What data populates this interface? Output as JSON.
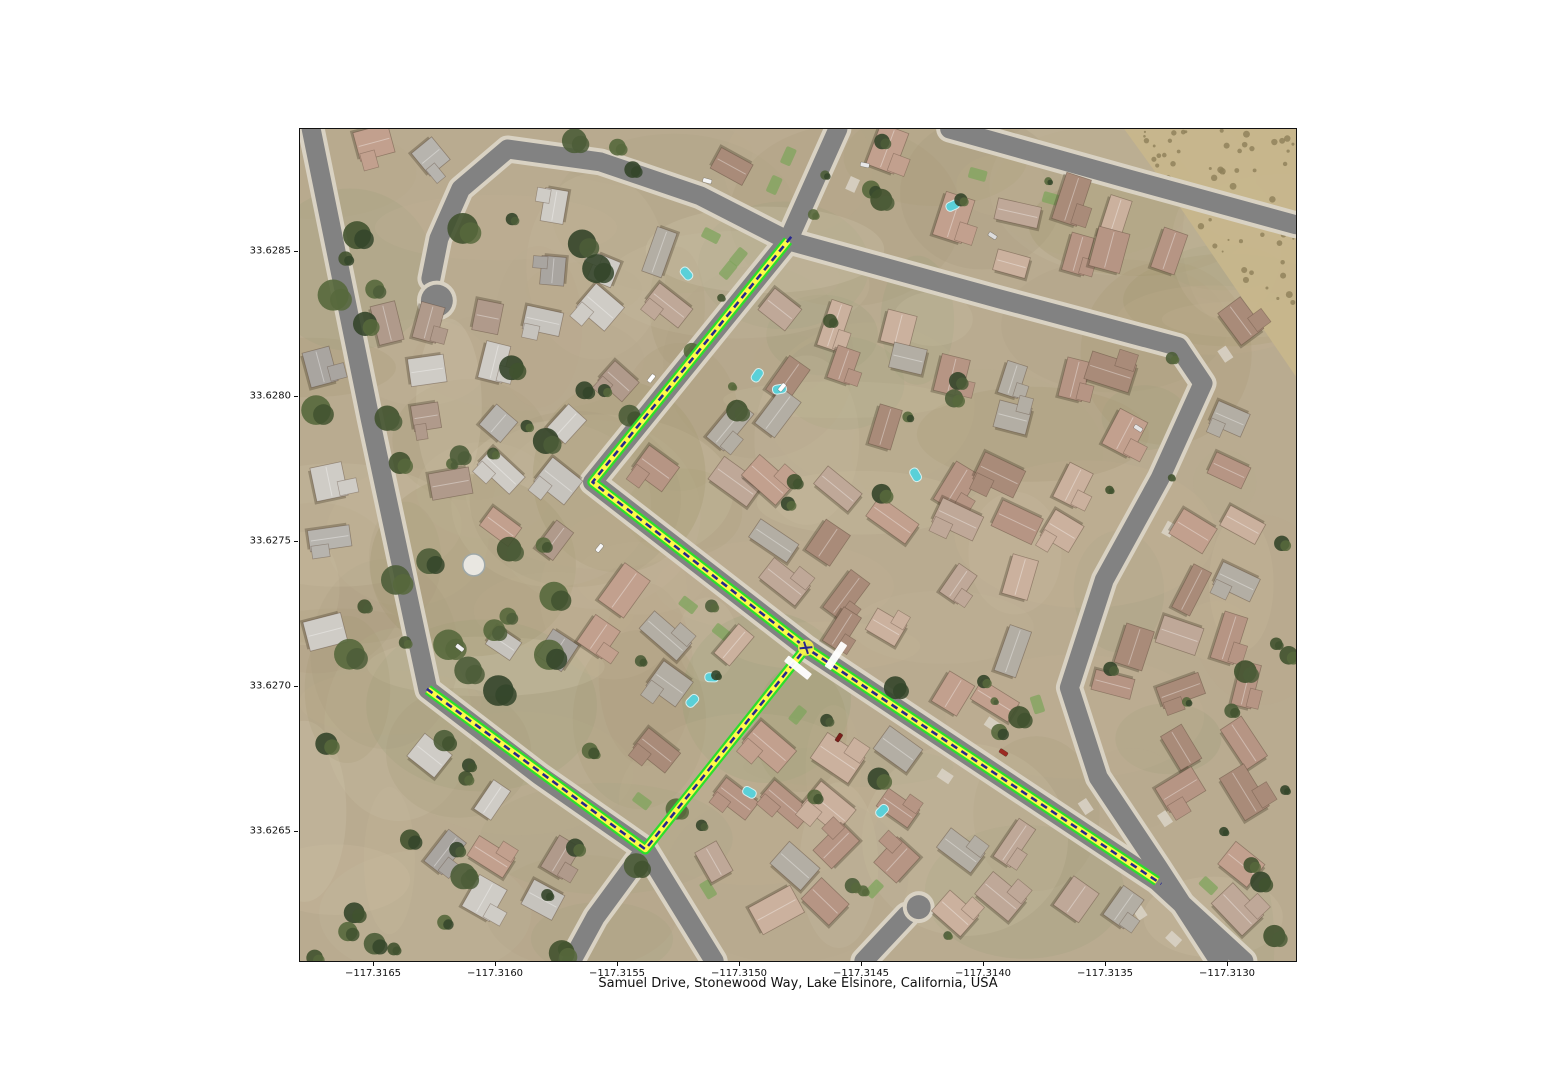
{
  "figure": {
    "title": "Samuel Drive, Stonewood Way, Lake Elsinore, California, USA",
    "background": "#ffffff"
  },
  "axes": {
    "x_ticks": [
      {
        "label": "−117.3165",
        "px": 74
      },
      {
        "label": "−117.3160",
        "px": 196
      },
      {
        "label": "−117.3155",
        "px": 318
      },
      {
        "label": "−117.3150",
        "px": 440
      },
      {
        "label": "−117.3145",
        "px": 562
      },
      {
        "label": "−117.3140",
        "px": 684
      },
      {
        "label": "−117.3135",
        "px": 806
      },
      {
        "label": "−117.3130",
        "px": 928
      }
    ],
    "y_ticks": [
      {
        "label": "33.6285",
        "px": 123
      },
      {
        "label": "33.6280",
        "px": 268
      },
      {
        "label": "33.6275",
        "px": 413
      },
      {
        "label": "33.6270",
        "px": 558
      },
      {
        "label": "33.6265",
        "px": 703
      }
    ]
  },
  "map": {
    "colors": {
      "ground": "#b9ab90",
      "scrub": "#c7b68c",
      "asphalt": "#828282",
      "sidewalk": "#d9d2c3",
      "route_casing": "#2cdf2c",
      "route_fill": "#fdf948",
      "route_center": "#26268f",
      "pool": "#5ad0d8",
      "lawn": "#7fa45c"
    },
    "route": {
      "name": "highlighted-route",
      "legs": [
        {
          "name": "north-leg",
          "points": [
            [
              489,
              112
            ],
            [
              293,
              354
            ],
            [
              507,
              520
            ]
          ]
        },
        {
          "name": "southeast-leg",
          "points": [
            [
              507,
              520
            ],
            [
              859,
              754
            ]
          ]
        },
        {
          "name": "west-leg",
          "points": [
            [
              507,
              520
            ],
            [
              346,
              722
            ],
            [
              128,
              562
            ]
          ]
        }
      ]
    },
    "streets": [
      {
        "name": "left-road",
        "points": [
          [
            11,
            0
          ],
          [
            70,
            290
          ],
          [
            128,
            562
          ],
          [
            240,
            648
          ],
          [
            346,
            722
          ],
          [
            415,
            834
          ]
        ]
      },
      {
        "name": "left-road-fork",
        "points": [
          [
            346,
            722
          ],
          [
            296,
            790
          ],
          [
            272,
            834
          ]
        ]
      },
      {
        "name": "route-street",
        "points": [
          [
            539,
            0
          ],
          [
            489,
            112
          ],
          [
            293,
            354
          ],
          [
            507,
            520
          ],
          [
            859,
            754
          ],
          [
            946,
            834
          ]
        ]
      },
      {
        "name": "loop-street-east",
        "points": [
          [
            489,
            112
          ],
          [
            700,
            170
          ],
          [
            880,
            218
          ],
          [
            905,
            255
          ],
          [
            862,
            350
          ],
          [
            806,
            452
          ],
          [
            771,
            560
          ],
          [
            800,
            650
          ],
          [
            860,
            740
          ],
          [
            921,
            834
          ]
        ]
      },
      {
        "name": "top-right-street",
        "points": [
          [
            651,
            0
          ],
          [
            830,
            50
          ],
          [
            998,
            96
          ]
        ]
      },
      {
        "name": "bottom-cul-de-sac",
        "points": [
          [
            565,
            834
          ],
          [
            608,
            788
          ]
        ]
      },
      {
        "name": "top-left-cul-de-sac",
        "points": [
          [
            489,
            112
          ],
          [
            401,
            67
          ],
          [
            301,
            33
          ],
          [
            208,
            20
          ],
          [
            161,
            60
          ],
          [
            139,
            110
          ],
          [
            131,
            150
          ]
        ]
      }
    ],
    "bulbs": [
      [
        137,
        172,
        16
      ],
      [
        620,
        780,
        12
      ]
    ],
    "markers": {
      "white_bars": [
        {
          "x": 499,
          "y": 540,
          "angle": 38.6
        },
        {
          "x": 537,
          "y": 528,
          "angle": 123.6
        }
      ],
      "junction": {
        "x": 507,
        "y": 520
      }
    }
  }
}
